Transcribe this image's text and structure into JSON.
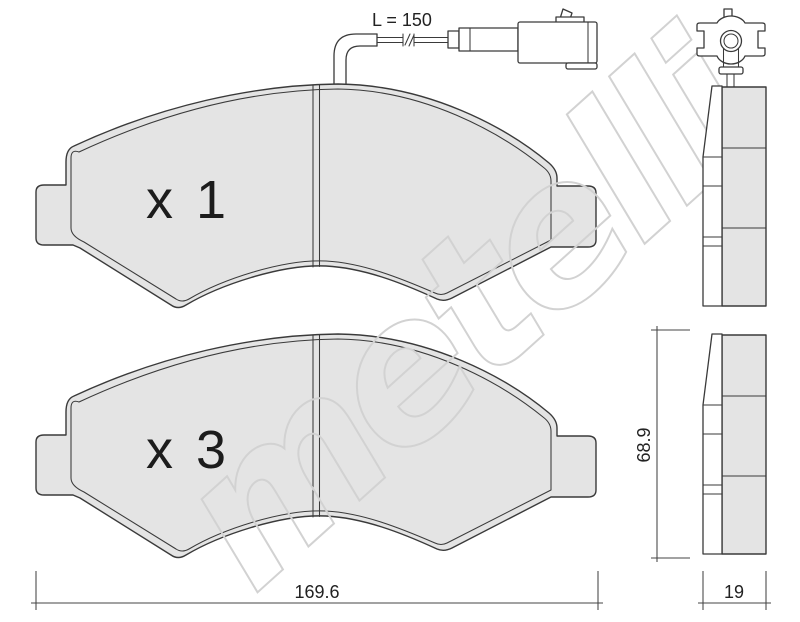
{
  "watermark": {
    "text": "metelli"
  },
  "pads": {
    "front_view_1": {
      "quantity_label": "x 1"
    },
    "front_view_2": {
      "quantity_label": "x 3"
    }
  },
  "sensor": {
    "length_label": "L = 150"
  },
  "dimensions": {
    "total_width": "169.6",
    "pad_height": "68.9",
    "pad_thickness": "19"
  },
  "colors": {
    "background": "#ffffff",
    "outline": "#3a3a3a",
    "pad_fill": "#e4e4e4",
    "watermark_stroke": "#d2d2d2",
    "dimension_text": "#222222"
  }
}
